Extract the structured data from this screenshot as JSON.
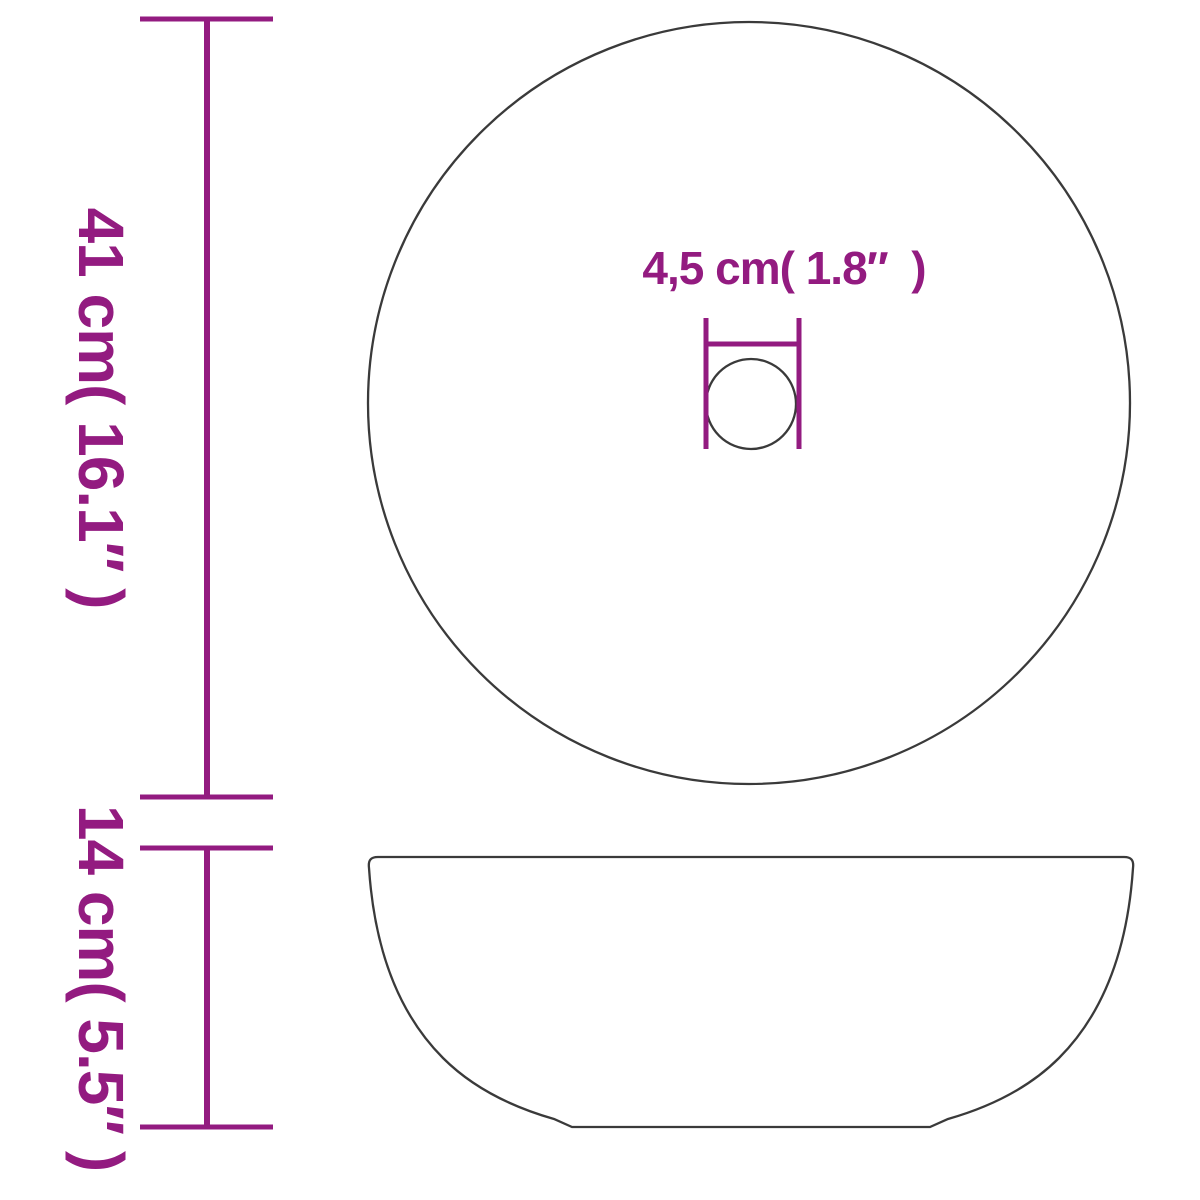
{
  "colors": {
    "accent": "#931b80",
    "outline": "#3a3a3a",
    "background": "#ffffff"
  },
  "dimension_labels": {
    "total_height": "41 cm( 16.1″ )",
    "basin_height": "14 cm( 5.5″ )",
    "drain_diameter": "4,5 cm( 1.8″  )"
  }
}
